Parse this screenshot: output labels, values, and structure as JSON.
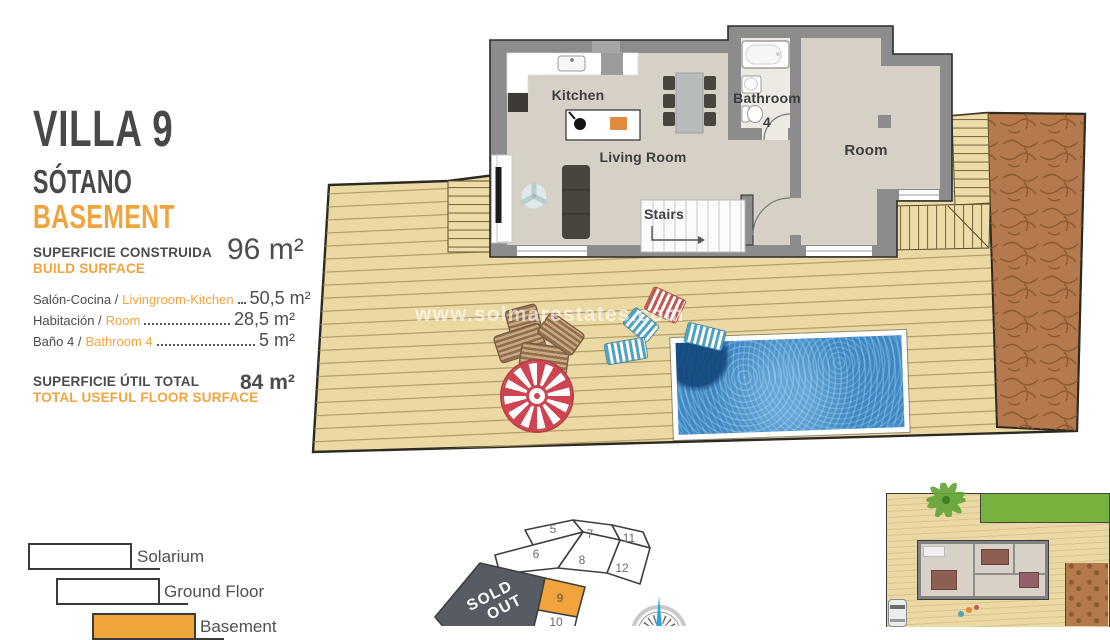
{
  "panel": {
    "title": "VILLA 9",
    "subtitle_es": "SÓTANO",
    "subtitle_en": "BASEMENT",
    "build_surface_label_es": "SUPERFICIE CONSTRUIDA",
    "build_surface_label_en": "BUILD SURFACE",
    "build_surface_value": "96 m²",
    "rooms": [
      {
        "label_es": "Salón-Cocina /",
        "label_en": "Livingroom-Kitchen",
        "value": "50,5 m²"
      },
      {
        "label_es": "Habitación /",
        "label_en": "Room",
        "value": "28,5 m²"
      },
      {
        "label_es": "Baño 4 /",
        "label_en": "Bathroom 4",
        "value": "5 m²"
      }
    ],
    "total_label_es": "SUPERFICIE ÚTIL TOTAL",
    "total_label_en": "TOTAL USEFUL FLOOR SURFACE",
    "total_value": "84 m²"
  },
  "legend": {
    "items": [
      {
        "label": "Solarium",
        "fill": "#FFFFFF"
      },
      {
        "label": "Ground Floor",
        "fill": "#FFFFFF"
      },
      {
        "label": "Basement",
        "fill": "#F2A43C"
      }
    ]
  },
  "floorplan": {
    "labels": {
      "kitchen": "Kitchen",
      "living_room": "Living Room",
      "bathroom": "Bathroom",
      "bathroom_number": "4",
      "room": "Room",
      "stairs": "Stairs"
    }
  },
  "watermark": "www.solmarestates.com",
  "plot_map": {
    "plots": [
      {
        "number": "5"
      },
      {
        "number": "7"
      },
      {
        "number": "11"
      },
      {
        "number": "6"
      },
      {
        "number": "8"
      },
      {
        "number": "12"
      },
      {
        "number": "9"
      },
      {
        "number": "10"
      }
    ],
    "highlighted_plot": "9",
    "sold_out_line1": "SOLD",
    "sold_out_line2": "OUT"
  },
  "colors": {
    "accent_orange": "#F2A43C",
    "title_gray": "#48484B",
    "deck_wood": "#EBD9A4",
    "dirt_brown": "#B5794E",
    "wall_gray": "#8C8C8C",
    "interior_floor": "#D6D0C7",
    "pool_water": "#3F86C2",
    "sold_out_badge": "#565B64",
    "parasol_red": "#CE4450"
  }
}
